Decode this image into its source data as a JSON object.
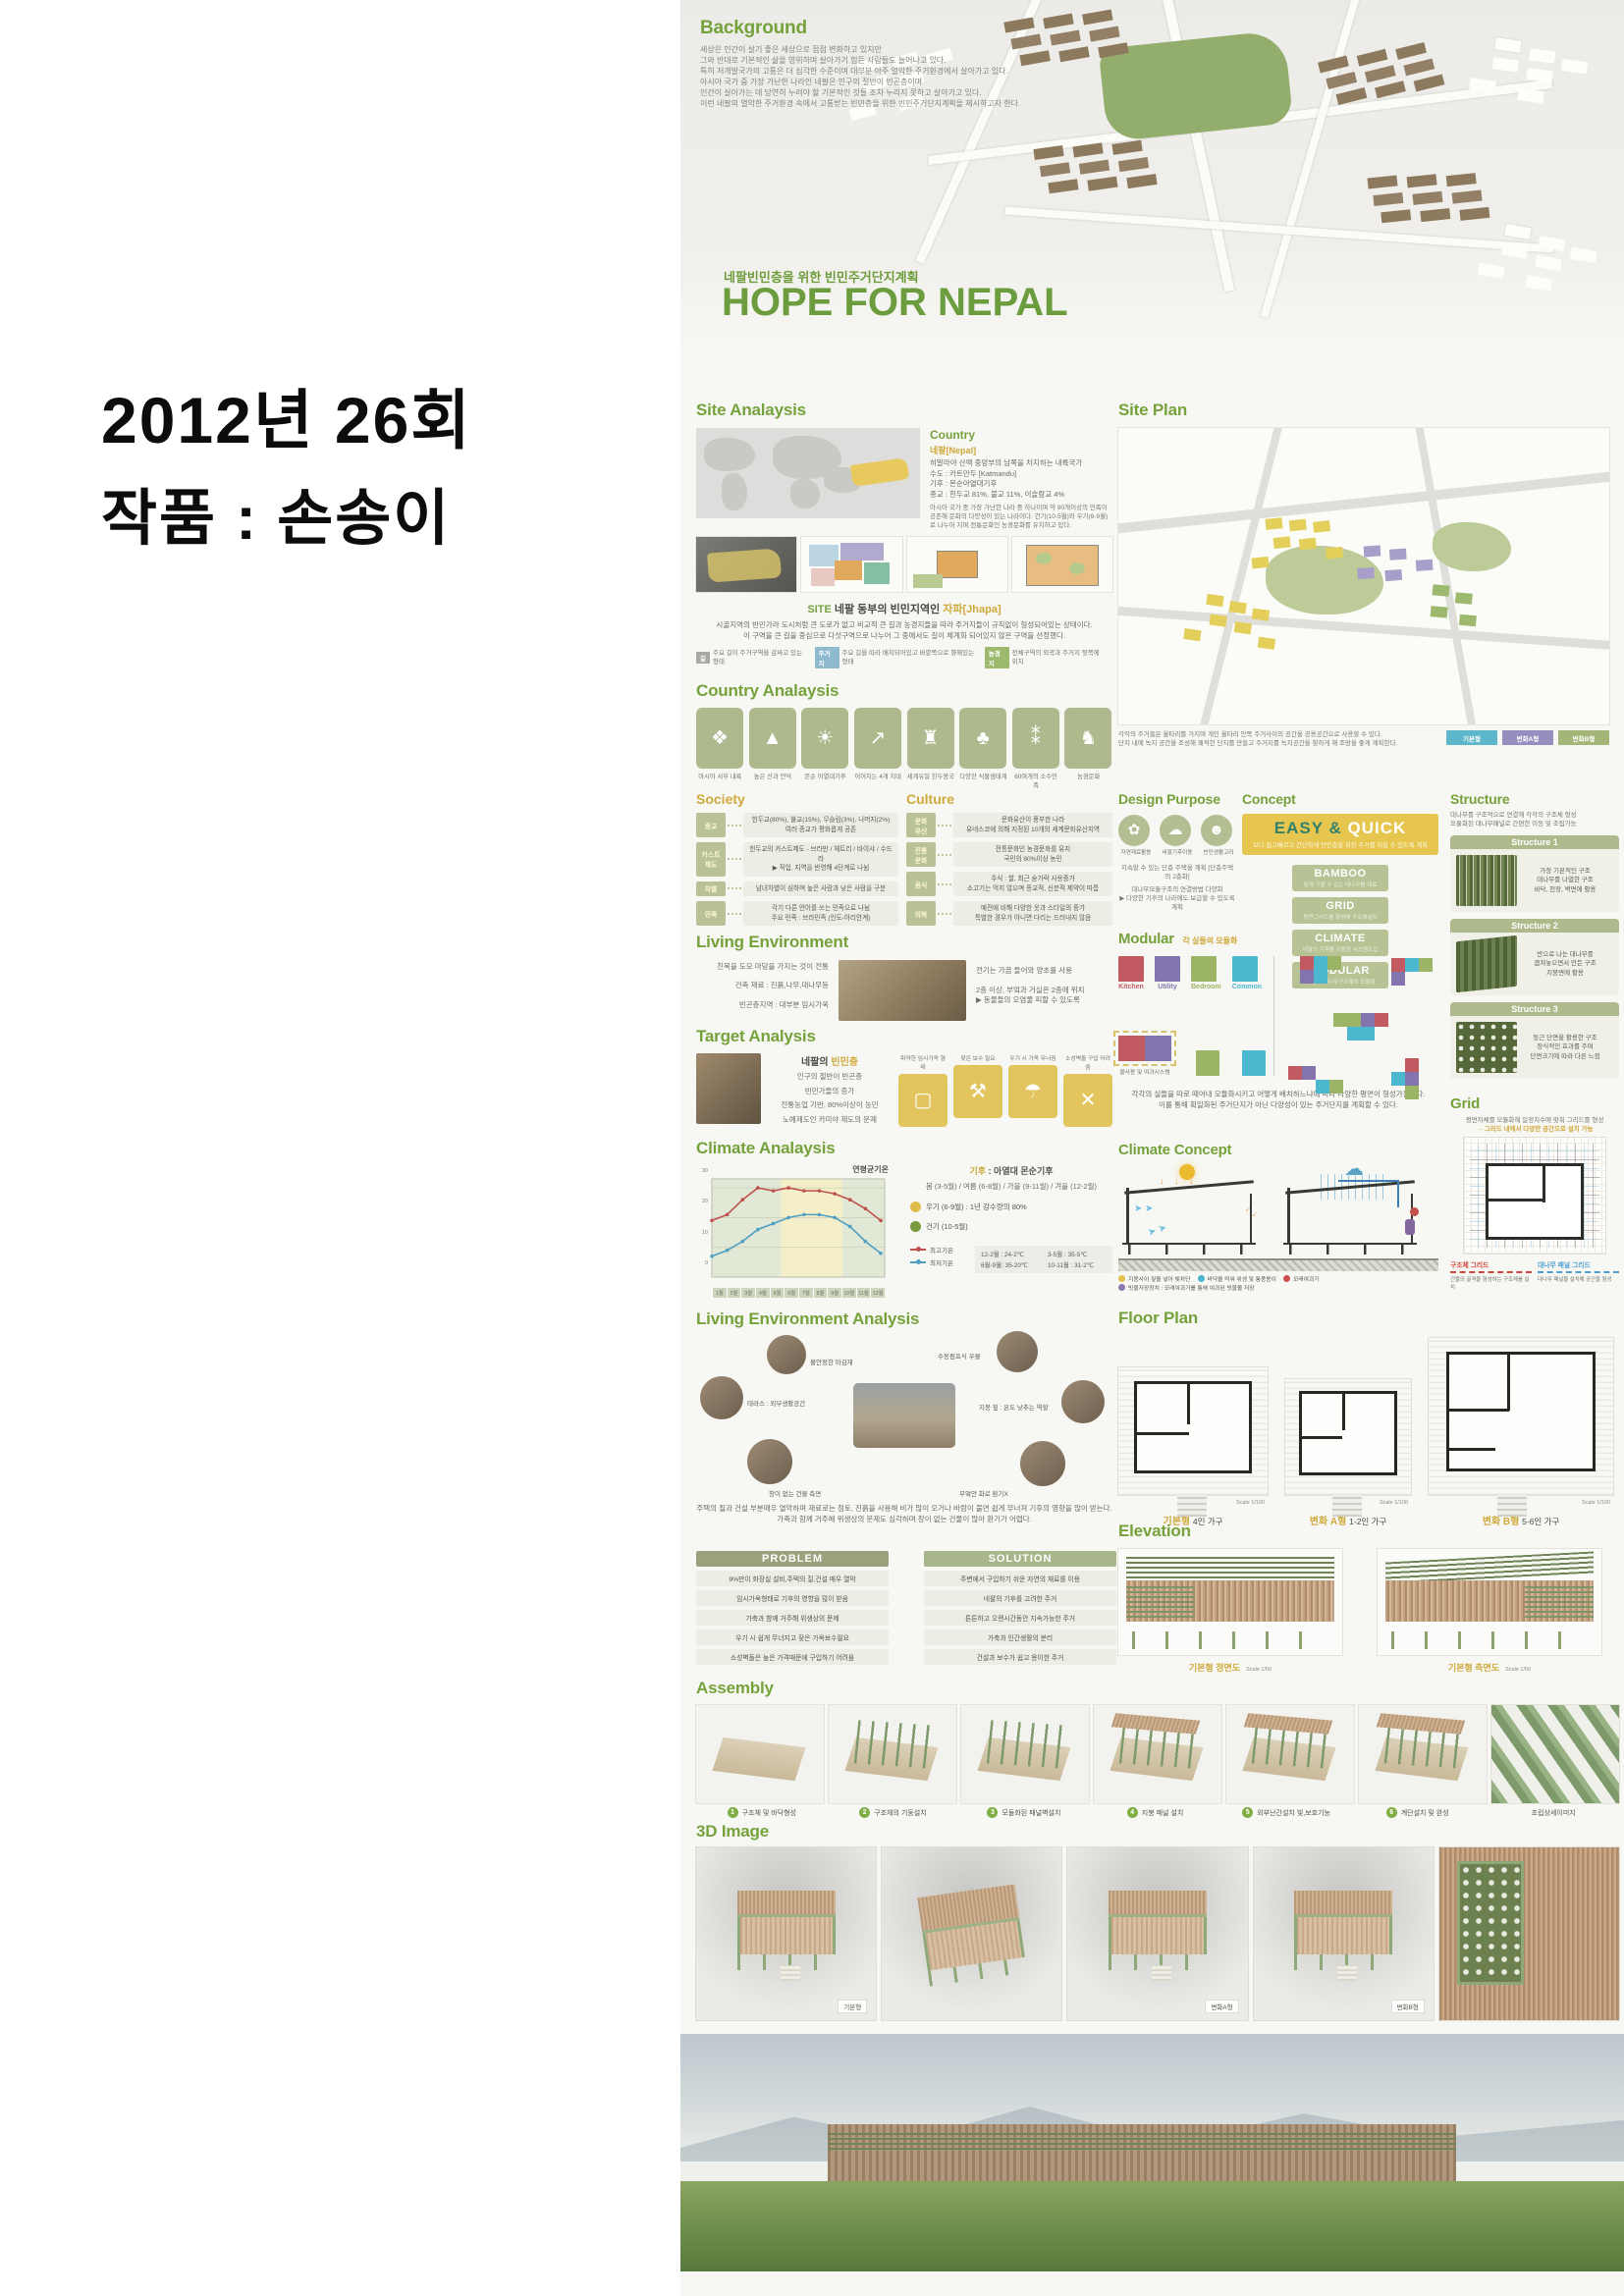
{
  "left_page": {
    "title_line1": "2012년 26회",
    "title_line2": "작품 : 손송이"
  },
  "hero": {
    "background_title": "Background",
    "background_lines": [
      "세상은 인간이 살기 좋은 세상으로 점점 변화하고 있지만",
      "그와 반대로 기본적인 삶을 영위하며 살아가기 힘든 사람들도 늘어나고 있다.",
      "특히 저개발국가의 고통은 더 심각한 수준이며 대부분 아주 열악한 주거환경에서 살아가고 있다.",
      "아시아 국가 중 가장 가난한 나라인 네팔은 인구의 절반이 빈곤층이며",
      "인간이 살아가는 데 당연히 누려야 할 기본적인 것들 조차 누리지 못하고 살아가고 있다.",
      "이런 네팔의 열악한 주거환경 속에서 고통받는 빈민층을 위한 빈민주거단지계획을 제시하고자 한다."
    ],
    "subtitle": "네팔빈민층을 위한 빈민주거단지계획",
    "title": "HOPE FOR NEPAL",
    "accent_green": "#6b9c3e"
  },
  "site_analysis": {
    "title": "Site Analaysis",
    "country": {
      "title": "Country",
      "name": "네팔[Nepal]",
      "lines": "히말라야 산맥 중앙부의 남쪽을 차지하는 내륙국가\n수도 : 카트만두 [Katmandu]\n기후 : 몬순아열대기후\n종교 : 힌두교 81%, 불교 11%, 이슬람교 4%",
      "desc": "아시아 국가 중 가장 가난한 나라 중 하나이며 약 90개이상의 민족이 공존해 문화의 다양성이 있는 나라이다. 건기(10-5월)와 우기(6-9월)로 나누어 지며 전통문화인 농경문화를 유지하고 있다."
    },
    "site_label": "SITE",
    "site_title": "네팔 동부의 빈민지역인",
    "site_name": "자파[Jhapa]",
    "desc1": "시골지역의 빈민가라 도시처럼 큰 도로가 없고 비교적 큰 길과 농경지들을 따라 주거지들이 규칙없이 형성되어있는 상태이다.",
    "desc2": "이 구역을 큰 길을 중심으로 다섯구역으로 나누어 그 중에서도 길이 체계화 되어있지 않은 구역을 선정했다.",
    "legend": [
      {
        "tag": "길",
        "color": "#a8a8a2",
        "text": "주요 길이 주거구역을 감싸고 있는 형태"
      },
      {
        "tag": "주거지",
        "color": "#8fb9cf",
        "text": "주요 길을 따라 배치되어있고 바깥쪽으로 향해있는 형태"
      },
      {
        "tag": "농경지",
        "color": "#9cb96e",
        "text": "전체구역의 외곽과 주거지 뒷쪽에 위치"
      }
    ]
  },
  "site_plan": {
    "title": "Site Plan",
    "caption": "각각의 주거들은 울타리를 가지며 개인 울타리 안쪽 주거사이의 공간을 공용공간으로 사용할 수 있다.\n단지 내에 녹지 공간을 조성해 쾌적한 단지를 만들고 주거지를 녹지공간을 향하게 해 조망을 좋게 계획한다.",
    "legend": [
      {
        "label": "기본형",
        "color": "#5bb7c9"
      },
      {
        "label": "변화A형",
        "color": "#958fc0"
      },
      {
        "label": "변화B형",
        "color": "#a3b577"
      }
    ]
  },
  "country_analysis": {
    "title": "Country Analaysis",
    "items": [
      {
        "icon": "asia-inland-icon",
        "glyph": "❖",
        "label": "아시아 서부 내륙"
      },
      {
        "icon": "mountains-icon",
        "glyph": "▲",
        "label": "높은 산과 언덕"
      },
      {
        "icon": "monsoon-climate-icon",
        "glyph": "☀",
        "label": "몬순 아열대기후"
      },
      {
        "icon": "four-zones-icon",
        "glyph": "↗",
        "label": "이어지는 4개 지대"
      },
      {
        "icon": "hindu-temple-icon",
        "glyph": "♜",
        "label": "세계유일 힌두왕국"
      },
      {
        "icon": "plant-ecosystem-icon",
        "glyph": "♣",
        "label": "다양한 식물생태계"
      },
      {
        "icon": "ethnic-groups-icon",
        "glyph": "⁑",
        "label": "60여개의 소수민족"
      },
      {
        "icon": "farming-culture-icon",
        "glyph": "♞",
        "label": "농경문화"
      }
    ]
  },
  "society": {
    "title": "Society",
    "rows": [
      {
        "tag": "종교",
        "text": "힌두교(80%), 불교(15%), 무슬림(3%), 나머지(2%)\n여러 종교가 평화롭게 공존"
      },
      {
        "tag": "카스트\n제도",
        "text": "힌두교의 카스트제도 - 브라만 / 체트리 / 바이샤 / 수드라\n▶ 직업, 지역을 반영해 4단계로 나뉨"
      },
      {
        "tag": "차별",
        "text": "남녀차별이 심하며 높은 사람과 낮은 사람을 구분"
      },
      {
        "tag": "민족",
        "text": "각기 다른 언어를 쓰는 민족으로 나뉨\n주요 민족 : 브라민족 (인도-아리안계)"
      }
    ]
  },
  "culture": {
    "title": "Culture",
    "rows": [
      {
        "tag": "문화\n유산",
        "text": "문화유산이 풍부한 나라\n유네스코에 의해 지정된 10개의 세계문화유산지역"
      },
      {
        "tag": "전통\n문화",
        "text": "전통문화인 농경문화를 유지\n국민의 80%이상 농민"
      },
      {
        "tag": "음식",
        "text": "주식 : 쌀, 최근 숟가락 사용증가\n소고기는 먹지 않으며 종교적, 신분적 제약이 따름"
      },
      {
        "tag": "의복",
        "text": "예전에 비해 다양한 옷과 스타일의 증가\n특별한 경우가 아니면 다리는 드러내지 않음"
      }
    ]
  },
  "design_purpose": {
    "title": "Design Purpose",
    "items": [
      {
        "icon": "natural-material-icon",
        "glyph": "✿",
        "label": "자연재료활용"
      },
      {
        "icon": "nepal-climate-icon",
        "glyph": "☁",
        "label": "네팔기후이용"
      },
      {
        "icon": "poor-life-icon",
        "glyph": "☻",
        "label": "빈민생활고려"
      }
    ],
    "line1": "지속할 수 있는 단층 주택을 계획 [단층주택의 2층화]",
    "line2": "대나무모듈구조의 연결방법 다양화",
    "line3": "▶ 다양한 기후의 나라에도 보급할 수 있도록 계획"
  },
  "concept": {
    "title": "Concept",
    "banner_title_1": "EASY &",
    "banner_title_2": " QUICK",
    "banner_sub": "보다 쉽고빠르고 간단하게 빈민층을 위한 주거를 지을 수 있도록 계획",
    "boxes": [
      {
        "name": "BAMBOO",
        "desc": "쉽게 구할 수 있는 대나무를 재료"
      },
      {
        "name": "GRID",
        "desc": "평면그리드를 형성해 구조체설치"
      },
      {
        "name": "CLIMATE",
        "desc": "네팔의 기후를 이용한 시스템도입"
      },
      {
        "name": "MODULAR",
        "desc": "각 실과 대나무구조체의 모듈화"
      }
    ]
  },
  "structure": {
    "title": "Structure",
    "intro": "대나무를 구조적으로 연결해 각각의 구조체 형성\n모듈화된 대나무패널로 간편한 이동 및 조립가능",
    "boxes": [
      {
        "title": "Structure 1",
        "lines": "가장 기본적인 구조\n대나무를 나열한 구조\n바닥, 천장, 벽면에 활용"
      },
      {
        "title": "Structure 2",
        "lines": "반으로 나눈 대나무를\n겹쳐놓으면서 만든 구조\n지붕면에 활용"
      },
      {
        "title": "Structure 3",
        "lines": "둥근 단면을 활용한 구조\n장식적인 효과를 주며\n단면크기에 따라 다른 느낌"
      }
    ]
  },
  "modular": {
    "title": "Modular",
    "subtitle": "각 실들의 모듈화",
    "rooms": [
      {
        "name": "Kitchen",
        "color": "#c25a62"
      },
      {
        "name": "Utility",
        "color": "#8374ae"
      },
      {
        "name": "Bedroom",
        "color": "#9cb466"
      },
      {
        "name": "Common",
        "color": "#4cb8d0"
      }
    ],
    "water_note": "물사용 및 여과시스템",
    "caption": "각각의 실들을 따로 떼어내 모듈화시키고 어떻게 배치하느냐에 따라 다양한 평면이 형성가능하다.\n이를 통해 획일화된 주거단지가 아닌 다양성이 있는 주거단지를 계획할 수 있다."
  },
  "grid_section": {
    "title": "Grid",
    "line1": "평면자체를 모듈화해 일정치수에 맞춰 그리드를 형성",
    "line2": "→ 그리드 내에서 다양한 공간으로 설치 가능",
    "legend1_title": "구조체 그리드",
    "legend1_desc": "건물의 골격을 형성하는 구조체를 설치",
    "legend1_color": "#d0483c",
    "legend2_title": "대나무 패널 그리드",
    "legend2_desc": "대나무 패널을 설치해 공간을 형성",
    "legend2_color": "#4f9fd0"
  },
  "living_environment": {
    "title": "Living Environment",
    "left_items": [
      "친목을 도모 마당을 가지는 것이 전통",
      "건축 재료 : 진흙,나무,대나무등",
      "빈곤층지역 : 대부분 임시가옥"
    ],
    "right_items": [
      "전기는 가끔 들어와 양초를 사용",
      "2층 이상, 부엌과 거실은 2층에 위치\n▶ 동물들의 오염물 피할 수 있도록"
    ]
  },
  "target_analysis": {
    "title": "Target Analysis",
    "subject_prefix": "네팔의",
    "subject_accent": "빈민층",
    "items": [
      "인구의 절반이 빈곤층",
      "빈민가들의 증가",
      "전통농업 기반, 80%이상이 농민",
      "노예제도인 카미야 제도의 문제"
    ],
    "tiles": [
      {
        "icon": "weak-shelter-icon",
        "glyph": "▢",
        "label": "취약한 임시가옥 형태"
      },
      {
        "icon": "repair-hammer-icon",
        "glyph": "⚒",
        "label": "잦은 보수 필요"
      },
      {
        "icon": "rainy-collapse-icon",
        "glyph": "☂",
        "label": "우기 시 가옥 무너짐"
      },
      {
        "icon": "no-brick-icon",
        "glyph": "✕",
        "label": "소성벽돌 구입 어려움"
      }
    ],
    "tile_color": "#e2c55e"
  },
  "climate": {
    "title": "Climate Analaysis",
    "chart_title": "연평균기온",
    "label_weather": "기후",
    "weather_text": ": 아열대 몬순기후",
    "seasons": "봄 (3-5월) / 여름 (6-8월) / 가을 (9-11월) / 겨울 (12-2월)",
    "rainy": "우기 (6-9월) : 1년 강수량의 80%",
    "dry": "건기 (10-5월)",
    "rainy_color": "#e0bc4a",
    "dry_color": "#7a9a3f",
    "temps": [
      "12-2월 : 24-2℃",
      "3-5월 : 35-5℃",
      "6월-9월: 35-20℃",
      "10-11월 : 31-2℃"
    ]
  },
  "chart_data": {
    "type": "line",
    "title": "연평균기온",
    "categories": [
      "1월",
      "2월",
      "3월",
      "4월",
      "5월",
      "6월",
      "7월",
      "8월",
      "9월",
      "10월",
      "11월",
      "12월"
    ],
    "series": [
      {
        "name": "최고기온",
        "color": "#c0504d",
        "values": [
          19,
          21,
          26,
          30,
          29,
          30,
          29,
          29,
          28,
          26,
          23,
          19
        ]
      },
      {
        "name": "최저기온",
        "color": "#4f9fc4",
        "values": [
          7,
          9,
          12,
          16,
          18,
          20,
          21,
          21,
          20,
          17,
          12,
          8
        ]
      }
    ],
    "ylim": [
      0,
      33
    ],
    "yticks": [
      0,
      10,
      20,
      30
    ],
    "xlabel": "월",
    "ylabel": "기온(℃)",
    "rain_band_months": [
      6,
      9
    ],
    "grid": true,
    "legend_position": "bottom-right"
  },
  "lea": {
    "title": "Living Environment Analysis",
    "labels": [
      "불안정한 마감재",
      "테라스 : 외부생활공간",
      "창이 없는 건물 측면",
      "수동펌프식 우물",
      "지붕 짚 : 온도 낮추는 역할",
      "부엌안 화로 환기X"
    ],
    "paragraph": "주택의 질과 건설 부분매우 열악하며 재료로는 점토, 진흙을 사용해 비가 많이 오거나 바람이 불면 쉽게 무너져 기후의 영향을 많이 받는다.\n가축과 함께 거주해 위생상의 문제도 심각하며 창이 없는 건물이 많아 환기가 어렵다."
  },
  "problem_solution": {
    "problem_header": "PROBLEM",
    "problem_color": "#9aa17c",
    "problem_items": [
      "9%만이 화장실 설비,주택의 질,건설 매우 열악",
      "임시가옥형태로 기후의 영향을 많이 받음",
      "가축과 함께 거주해 위생상의 문제",
      "우기 시 쉽게 무너지고 잦은 가옥보수필요",
      "소성벽돌은 높은 가격때문에 구입하기 어려움"
    ],
    "solution_header": "SOLUTION",
    "solution_color": "#a9b58a",
    "solution_items": [
      "주변에서 구입하기 쉬운 자연의 재료를 이용",
      "네팔의 기후를 고려한 주거",
      "튼튼하고 오랜시간동안 지속가능한 주거",
      "가축과 인간생활의 분리",
      "건설과 보수가 쉽고 용이한 주거"
    ]
  },
  "climate_concept": {
    "title": "Climate Concept",
    "legend": [
      {
        "color": "#e5c04a",
        "text": "지붕사이 짚을 넣어 빛차단"
      },
      {
        "color": "#4ab3cf",
        "text": "바닥을 띄워 위생 및 통풍용이"
      },
      {
        "color": "#c8504f",
        "text": "모래여과기"
      },
      {
        "color": "#8a77ae",
        "text": "빗물저장장치 : 모래여과기를 통해 여과된 빗물을 저장"
      }
    ]
  },
  "floor_plan": {
    "title": "Floor Plan",
    "plans": [
      {
        "name": "기본형",
        "desc": "4인 가구",
        "scale": "Scale  1/100"
      },
      {
        "name": "변화 A형",
        "desc": "1-2인 가구",
        "scale": "Scale  1/100"
      },
      {
        "name": "변화 B형",
        "desc": "5-6인 가구",
        "scale": "Scale  1/100"
      }
    ]
  },
  "elevation": {
    "title": "Elevation",
    "labels": [
      {
        "name": "기본형 정면도",
        "scale": "Scale  1/50"
      },
      {
        "name": "기본형 측면도",
        "scale": "Scale  1/50"
      }
    ]
  },
  "assembly": {
    "title": "Assembly",
    "steps": [
      {
        "num": "1",
        "label": "구조체 및 바닥형성"
      },
      {
        "num": "2",
        "label": "구조체의 기둥설치"
      },
      {
        "num": "3",
        "label": "모듈화된 패널벽설치"
      },
      {
        "num": "4",
        "label": "지붕 패널 설치"
      },
      {
        "num": "5",
        "label": "외부난간설치 빛,보호기능"
      },
      {
        "num": "6",
        "label": "계단설치 및 완성"
      }
    ],
    "extra": "조립상세이미지"
  },
  "three_d": {
    "title": "3D Image",
    "labels": [
      "기본형",
      "변화A형",
      "변화B형"
    ]
  }
}
